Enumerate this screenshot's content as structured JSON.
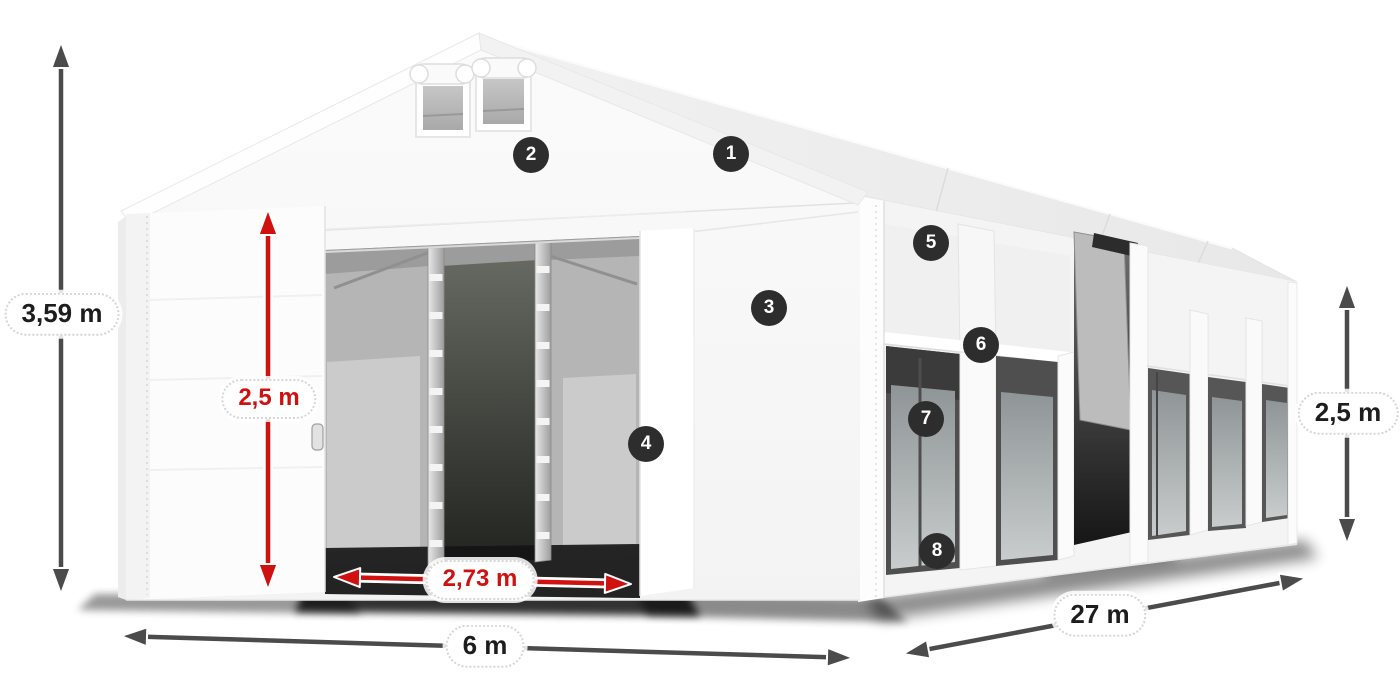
{
  "canvas": {
    "width": 1400,
    "height": 700,
    "background": "#ffffff"
  },
  "diagram": {
    "subject": "storage-tent-dimension-diagram",
    "feature_callouts": [
      {
        "number": "1",
        "x": 731,
        "y": 154
      },
      {
        "number": "2",
        "x": 531,
        "y": 155
      },
      {
        "number": "3",
        "x": 769,
        "y": 308
      },
      {
        "number": "4",
        "x": 646,
        "y": 444
      },
      {
        "number": "5",
        "x": 931,
        "y": 243
      },
      {
        "number": "6",
        "x": 981,
        "y": 345
      },
      {
        "number": "7",
        "x": 926,
        "y": 419
      },
      {
        "number": "8",
        "x": 937,
        "y": 551
      }
    ],
    "dimensions": [
      {
        "id": "total-height",
        "label": "3,59 m",
        "style": "gray",
        "pill": {
          "x": 62,
          "y": 314
        },
        "arrows": [
          {
            "x1": 61,
            "y1": 42,
            "x2": 61,
            "y2": 594
          }
        ]
      },
      {
        "id": "door-height",
        "label": "2,5 m",
        "style": "red",
        "pill": {
          "x": 269,
          "y": 399
        },
        "arrows": [
          {
            "x1": 268,
            "y1": 209,
            "x2": 268,
            "y2": 590
          }
        ]
      },
      {
        "id": "door-width",
        "label": "2,73 m",
        "style": "red",
        "pill": {
          "x": 480,
          "y": 580
        },
        "arrows": [
          {
            "x1": 334,
            "y1": 577,
            "x2": 631,
            "y2": 584
          }
        ]
      },
      {
        "id": "ground-width",
        "label": "6 m",
        "style": "gray",
        "pill": {
          "x": 485,
          "y": 646
        },
        "arrows": [
          {
            "x1": 121,
            "y1": 636,
            "x2": 853,
            "y2": 658
          }
        ]
      },
      {
        "id": "length",
        "label": "27 m",
        "style": "gray",
        "pill": {
          "x": 1100,
          "y": 615
        },
        "arrows": [
          {
            "x1": 903,
            "y1": 654,
            "x2": 1306,
            "y2": 578
          }
        ]
      },
      {
        "id": "side-height",
        "label": "2,5 m",
        "style": "gray",
        "pill": {
          "x": 1348,
          "y": 413
        },
        "arrows": [
          {
            "x1": 1347,
            "y1": 283,
            "x2": 1347,
            "y2": 544
          }
        ]
      }
    ]
  },
  "colors": {
    "dimension_red": "#cf1110",
    "dimension_gray": "#4b4b4b",
    "badge_background": "#2d2d2d",
    "badge_text": "#ffffff",
    "pill_background": "#ffffff",
    "pill_border": "#d6d6d6",
    "label_text": "#1d1d1d"
  }
}
